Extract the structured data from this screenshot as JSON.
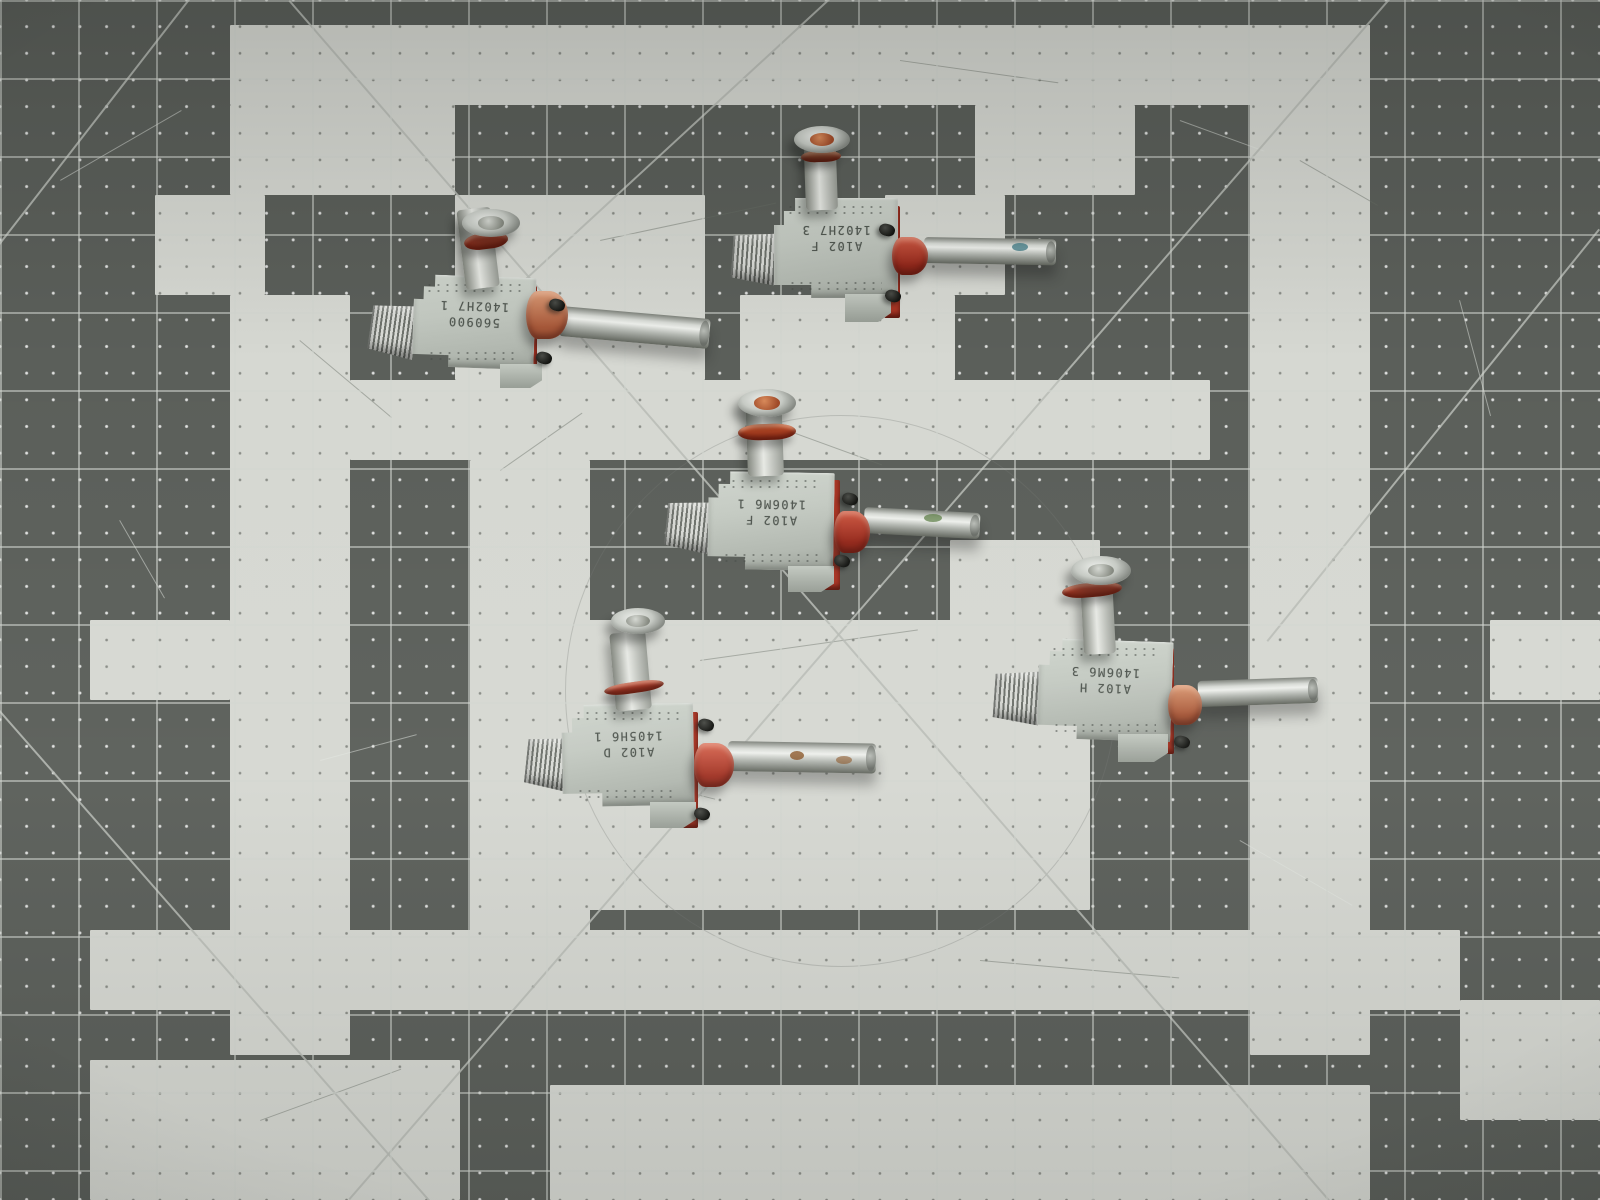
{
  "scene": {
    "title": "Five aluminum valve fittings on a gray and white checkered cutting mat"
  },
  "mat": {
    "cell_px": 78,
    "colors": {
      "dark_square": "#5b5f5a",
      "light_square": "#d6d8d2",
      "grid_line": "#d2d6d0",
      "diagonal_line": "#b9bcb6",
      "dot_on_dark": "#ffffff",
      "dot_on_light": "#3e423c"
    },
    "light_rects": [
      [
        230,
        25,
        1140,
        80
      ],
      [
        1250,
        25,
        120,
        1030
      ],
      [
        230,
        105,
        225,
        90
      ],
      [
        975,
        105,
        160,
        90
      ],
      [
        155,
        195,
        110,
        100
      ],
      [
        455,
        195,
        250,
        185
      ],
      [
        885,
        195,
        120,
        100
      ],
      [
        740,
        295,
        215,
        85
      ],
      [
        230,
        295,
        120,
        760
      ],
      [
        350,
        380,
        240,
        80
      ],
      [
        470,
        380,
        740,
        80
      ],
      [
        470,
        460,
        120,
        550
      ],
      [
        90,
        620,
        140,
        80
      ],
      [
        1490,
        620,
        110,
        80
      ],
      [
        470,
        620,
        620,
        290
      ],
      [
        950,
        540,
        150,
        90
      ],
      [
        90,
        930,
        1370,
        80
      ],
      [
        90,
        1060,
        370,
        140
      ],
      [
        550,
        1085,
        820,
        115
      ],
      [
        1460,
        1000,
        140,
        120
      ]
    ],
    "diagonals": [
      [
        290,
        0,
        1330,
        1200
      ],
      [
        1390,
        0,
        350,
        1200
      ],
      [
        190,
        0,
        0,
        245
      ],
      [
        830,
        0,
        445,
        355
      ],
      [
        0,
        710,
        430,
        1200
      ],
      [
        1600,
        230,
        1268,
        642
      ]
    ],
    "arc_scratch": {
      "cx": 840,
      "cy": 690,
      "r": 275
    },
    "scratches": [
      {
        "x": 60,
        "y": 180,
        "len": 140,
        "ang": -30,
        "tone": "light"
      },
      {
        "x": 1180,
        "y": 120,
        "len": 90,
        "ang": 20,
        "tone": "light"
      },
      {
        "x": 1460,
        "y": 300,
        "len": 120,
        "ang": 75,
        "tone": "light"
      },
      {
        "x": 320,
        "y": 760,
        "len": 100,
        "ang": -15,
        "tone": "light"
      },
      {
        "x": 1240,
        "y": 840,
        "len": 130,
        "ang": 30,
        "tone": "light"
      },
      {
        "x": 120,
        "y": 520,
        "len": 90,
        "ang": 60,
        "tone": "light"
      },
      {
        "x": 600,
        "y": 240,
        "len": 180,
        "ang": -12,
        "tone": "dark"
      },
      {
        "x": 900,
        "y": 60,
        "len": 160,
        "ang": 8,
        "tone": "dark"
      },
      {
        "x": 300,
        "y": 340,
        "len": 120,
        "ang": 40,
        "tone": "dark"
      },
      {
        "x": 700,
        "y": 660,
        "len": 220,
        "ang": -8,
        "tone": "dark"
      },
      {
        "x": 560,
        "y": 760,
        "len": 160,
        "ang": 14,
        "tone": "dark"
      },
      {
        "x": 980,
        "y": 960,
        "len": 200,
        "ang": 5,
        "tone": "dark"
      },
      {
        "x": 260,
        "y": 1120,
        "len": 150,
        "ang": -20,
        "tone": "dark"
      },
      {
        "x": 1300,
        "y": 160,
        "len": 90,
        "ang": 30,
        "tone": "dark"
      },
      {
        "x": 500,
        "y": 470,
        "len": 100,
        "ang": -35,
        "tone": "dark"
      },
      {
        "x": 760,
        "y": 420,
        "len": 130,
        "ang": 20,
        "tone": "dark"
      }
    ]
  },
  "part_colors": {
    "aluminum": "#c7cdc5",
    "copper_boss": [
      "#db9b76",
      "#a8593a"
    ],
    "red_boss": [
      "#cf5a44",
      "#95291c"
    ],
    "redpink_boss": [
      "#d96a55",
      "#a23526"
    ],
    "steel_tube": "#d7dad5",
    "screw_black": "#1e1f1d"
  },
  "parts": [
    {
      "name": "valve-1",
      "stamp": [
        "560900",
        "1402H7 1"
      ],
      "rot": 2,
      "body": [
        413,
        276,
        122,
        92
      ],
      "gasket": [
        523,
        286,
        14,
        86
      ],
      "foot": [
        500,
        364,
        42,
        24
      ],
      "threads": [
        370,
        303,
        46,
        54,
        8
      ],
      "stem": [
        466,
        208,
        34,
        80,
        -7
      ],
      "ring": [
        464,
        233,
        44,
        16,
        -7,
        "#bf4430"
      ],
      "disc": [
        462,
        209,
        58,
        28,
        "steel"
      ],
      "boss": [
        526,
        291,
        42,
        48,
        "copper"
      ],
      "tube": [
        560,
        306,
        150,
        30,
        5
      ],
      "marks": [],
      "screws": [
        [
          549,
          299
        ],
        [
          536,
          352
        ]
      ]
    },
    {
      "name": "valve-2",
      "stamp": [
        "A102 F",
        "1402H7 3"
      ],
      "rot": 0,
      "body": [
        774,
        198,
        124,
        100
      ],
      "gasket": [
        884,
        206,
        16,
        112
      ],
      "foot": [
        845,
        294,
        46,
        28
      ],
      "threads": [
        732,
        232,
        44,
        52,
        4
      ],
      "stem": [
        806,
        146,
        32,
        64,
        -2
      ],
      "ring": [
        801,
        151,
        40,
        11,
        -2,
        "#c3704a"
      ],
      "disc": [
        794,
        126,
        56,
        27,
        "copper"
      ],
      "boss": [
        892,
        237,
        36,
        38,
        "red"
      ],
      "tube": [
        924,
        237,
        132,
        26,
        1
      ],
      "marks": [
        [
          1012,
          243,
          16,
          8,
          "#3d7a85",
          0.75
        ]
      ],
      "screws": [
        [
          879,
          224
        ],
        [
          885,
          290
        ]
      ]
    },
    {
      "name": "valve-3",
      "stamp": [
        "A102 F",
        "1406M6 1"
      ],
      "rot": 1,
      "body": [
        708,
        472,
        126,
        98
      ],
      "gasket": [
        824,
        480,
        16,
        110
      ],
      "foot": [
        788,
        566,
        46,
        26
      ],
      "threads": [
        666,
        500,
        44,
        52,
        6
      ],
      "stem": [
        748,
        394,
        36,
        82,
        -2
      ],
      "ring": [
        738,
        424,
        58,
        16,
        -2,
        "#c1502a"
      ],
      "disc": [
        738,
        389,
        58,
        28,
        "copper"
      ],
      "boss": [
        834,
        511,
        36,
        42,
        "red"
      ],
      "tube": [
        864,
        507,
        116,
        26,
        3
      ],
      "marks": [
        [
          924,
          514,
          18,
          8,
          "#57793f",
          0.7
        ]
      ],
      "screws": [
        [
          842,
          493
        ],
        [
          834,
          555
        ]
      ]
    },
    {
      "name": "valve-4",
      "stamp": [
        "A102 D",
        "1405H6 1"
      ],
      "rot": -1,
      "body": [
        562,
        704,
        132,
        102
      ],
      "gasket": [
        682,
        712,
        16,
        116
      ],
      "foot": [
        650,
        802,
        46,
        26
      ],
      "threads": [
        526,
        736,
        44,
        54,
        6
      ],
      "stem": [
        616,
        632,
        36,
        78,
        -5
      ],
      "ring": [
        604,
        682,
        60,
        11,
        -8,
        "#a8392c"
      ],
      "disc": [
        611,
        608,
        54,
        26,
        "hex"
      ],
      "boss": [
        694,
        743,
        40,
        44,
        "redpink"
      ],
      "tube": [
        728,
        741,
        148,
        30,
        1
      ],
      "marks": [
        [
          790,
          751,
          14,
          9,
          "#8a5527",
          0.8
        ],
        [
          836,
          756,
          16,
          8,
          "#8a5527",
          0.6
        ]
      ],
      "screws": [
        [
          698,
          719
        ],
        [
          694,
          808
        ]
      ]
    },
    {
      "name": "valve-5",
      "stamp": [
        "A102 H",
        "1406M6 3"
      ],
      "rot": 2,
      "body": [
        1038,
        640,
        134,
        100
      ],
      "gasket": [
        1158,
        648,
        16,
        106
      ],
      "foot": [
        1118,
        734,
        50,
        28
      ],
      "threads": [
        994,
        670,
        46,
        54,
        4
      ],
      "stem": [
        1084,
        588,
        32,
        66,
        -3
      ],
      "ring": [
        1062,
        583,
        60,
        14,
        -5,
        "#bf4430"
      ],
      "disc": [
        1071,
        556,
        60,
        29,
        "steel"
      ],
      "boss": [
        1168,
        685,
        34,
        40,
        "copper"
      ],
      "tube": [
        1198,
        681,
        120,
        26,
        -2
      ],
      "marks": [],
      "screws": [
        [
          1174,
          736
        ]
      ]
    }
  ]
}
